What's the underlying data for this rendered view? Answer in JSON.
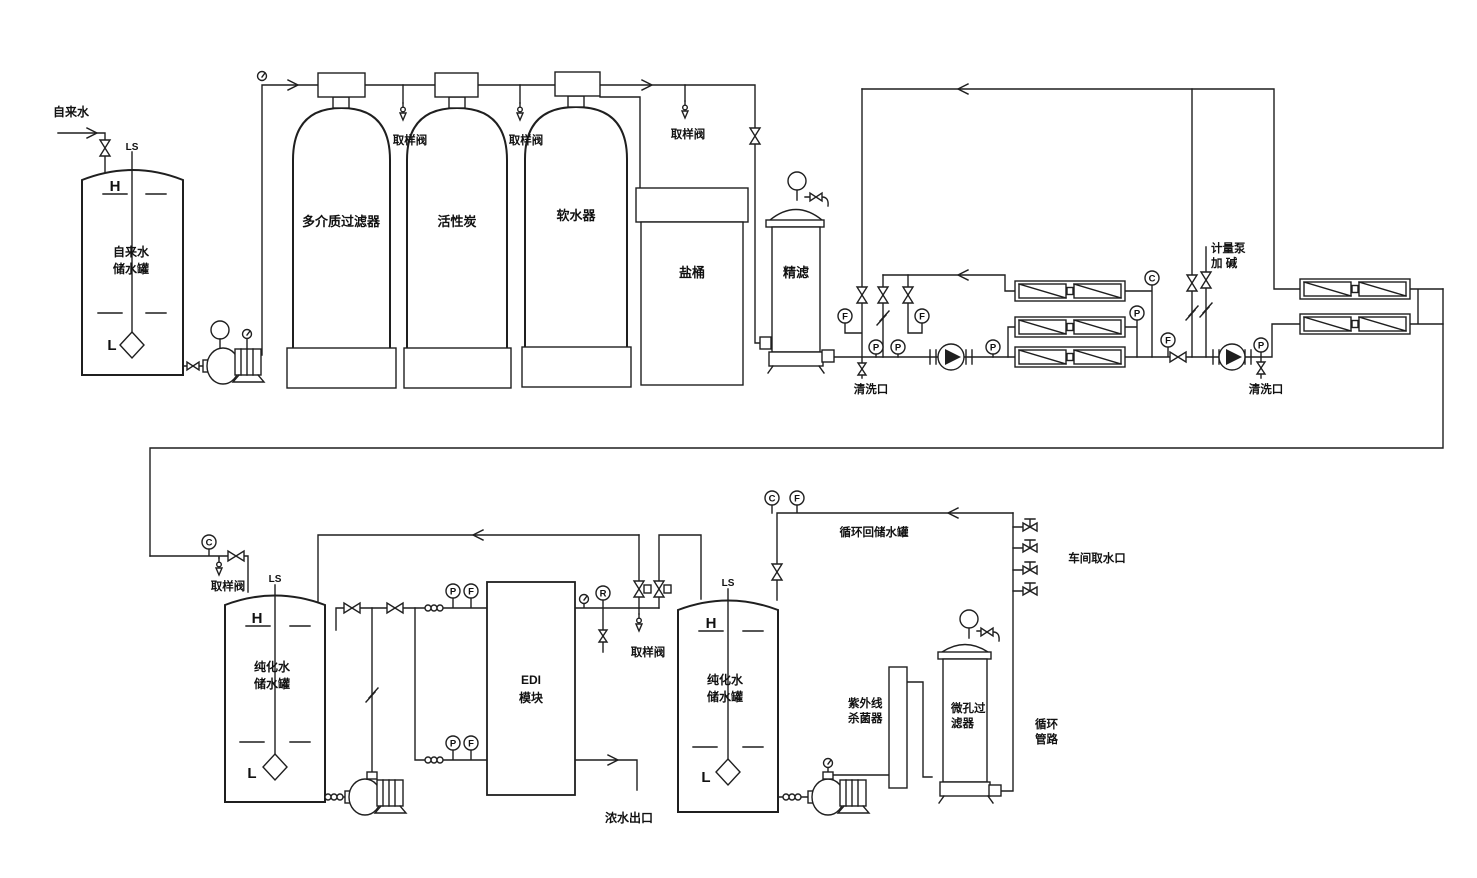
{
  "meta": {
    "type": "water-treatment-process-flow-diagram",
    "width": 1477,
    "height": 878
  },
  "colors": {
    "line": "#1f1f1f",
    "background": "#ffffff"
  },
  "letters": {
    "P": "P",
    "F": "F",
    "C": "C",
    "R": "R",
    "H": "H",
    "L": "L",
    "LS": "LS"
  },
  "labels": {
    "tap_water": "自来水",
    "raw_tank": [
      "自来水",
      "储水罐"
    ],
    "multimedia_filter": "多介质过滤器",
    "activated_carbon": "活性炭",
    "softener": "软水器",
    "salt_barrel": "盐桶",
    "fine_filter": "精滤",
    "sampling_valve": "取样阀",
    "cleaning_port": "清洗口",
    "metering_pump": "计量泵",
    "add_alkali": "加 碱",
    "edi": "EDI",
    "edi_module": "模块",
    "pure_tank": [
      "纯化水",
      "储水罐"
    ],
    "concentrate_outlet": "浓水出口",
    "recirc_return": "循环回储水罐",
    "workshop_intake": "车间取水口",
    "uv_sterilizer": [
      "紫外线",
      "杀菌器"
    ],
    "micro_filter": [
      "微孔过",
      "滤器"
    ],
    "circ_pipe": [
      "循环",
      "管路"
    ]
  }
}
